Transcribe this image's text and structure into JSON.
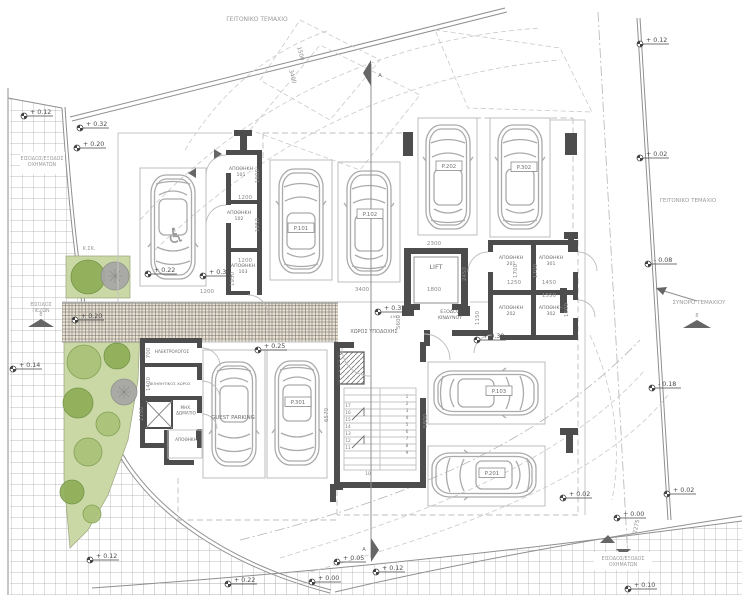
{
  "plan_title": "Ground floor parking site plan",
  "texts": [
    {
      "name": "neighbor-plot-top",
      "t": "ΓΕΙΤΟΝΙΚΟ ΤΕΜΑΧΙΟ",
      "x": 257,
      "y": 21,
      "s": 6,
      "cls": "lt"
    },
    {
      "name": "neighbor-plot-right",
      "t": "ΓΕΙΤΟΝΙΚΟ ΤΕΜΑΧΙΟ",
      "x": 688,
      "y": 202,
      "s": 5.5,
      "cls": "lt"
    },
    {
      "name": "plot-boundary-label",
      "t": "ΣΥΝΟΡΟ ΤΕΜΑΧΙΟΥ",
      "x": 699,
      "y": 304,
      "s": 5.5,
      "cls": "lt"
    },
    {
      "name": "vehicle-entry-top-label",
      "lines": [
        "ΕΙΣΟΔΟΣ/ΕΞΟΔΟΣ",
        "ΟΧΗΜΑΤΩΝ"
      ],
      "x": 42,
      "y": 160,
      "s": 4.8,
      "cls": "lt"
    },
    {
      "name": "vehicle-entry-bottom-label",
      "lines": [
        "ΕΙΣΟΔΟΣ/ΕΞΟΔΟΣ",
        "ΟΧΗΜΑΤΩΝ"
      ],
      "x": 623,
      "y": 560,
      "s": 4.8,
      "cls": "lt"
    },
    {
      "name": "pedestrian-entry-label",
      "lines": [
        "ΕΙΣΟΔΟΣ",
        "ΠΕΖΩΝ"
      ],
      "x": 41,
      "y": 306,
      "s": 4.8,
      "cls": "lt"
    },
    {
      "name": "ksk-label",
      "t": "Κ.ΣΚ.",
      "x": 89,
      "y": 250,
      "s": 5,
      "cls": "lt"
    },
    {
      "name": "lift-label",
      "t": "LIFT",
      "x": 436,
      "y": 269,
      "s": 6.5
    },
    {
      "name": "reception-label",
      "t": "ΧΩΡΟΣ ΥΠΟΔΟΧΗΣ",
      "x": 374,
      "y": 333,
      "s": 5
    },
    {
      "name": "emergency-exit-label",
      "lines": [
        "ΕΞΟΔΟΣ",
        "ΚΙΝΔΥΝΟΥ"
      ],
      "x": 450,
      "y": 313,
      "s": 4.7
    },
    {
      "name": "storage-101-label",
      "lines": [
        "ΑΠΟΘΗΚΗ",
        "101"
      ],
      "x": 241,
      "y": 170,
      "s": 4.7
    },
    {
      "name": "storage-102-label",
      "lines": [
        "ΑΠΟΘΗΚΗ",
        "102"
      ],
      "x": 239,
      "y": 214,
      "s": 4.7
    },
    {
      "name": "storage-103-label",
      "lines": [
        "ΑΠΟΘΗΚΗ",
        "103"
      ],
      "x": 243,
      "y": 267,
      "s": 4.7
    },
    {
      "name": "storage-201-label",
      "lines": [
        "ΑΠΟΘΗΚΗ",
        "201"
      ],
      "x": 511,
      "y": 259,
      "s": 4.7
    },
    {
      "name": "storage-301-label",
      "lines": [
        "ΑΠΟΘΗΚΗ",
        "301"
      ],
      "x": 551,
      "y": 259,
      "s": 4.7
    },
    {
      "name": "storage-202-label",
      "lines": [
        "ΑΠΟΘΗΚΗ",
        "202"
      ],
      "x": 511,
      "y": 309,
      "s": 4.7
    },
    {
      "name": "storage-302-label",
      "lines": [
        "ΑΠΟΘΗΚΗ",
        "302"
      ],
      "x": 551,
      "y": 309,
      "s": 4.7
    },
    {
      "name": "electrical-room-label",
      "t": "ΗΛΕΚΤΡΟΛΟΓΟΣ",
      "x": 172,
      "y": 353,
      "s": 4.2
    },
    {
      "name": "auxiliary-room-label",
      "t": "ΒΟΗΘΗΤΙΚΟΣ ΧΩΡΟΣ",
      "x": 170,
      "y": 385,
      "s": 3.9
    },
    {
      "name": "machine-room-label",
      "lines": [
        "ΜΗΧ.",
        "ΔΩΜΑΤΙΟ"
      ],
      "x": 186,
      "y": 409,
      "s": 4.2
    },
    {
      "name": "storage-small-label",
      "t": "ΑΠΟΘΗΚΗ",
      "x": 186,
      "y": 441,
      "s": 4.2
    },
    {
      "name": "section-a-top-label",
      "t": "A",
      "x": 380,
      "y": 77,
      "s": 5
    },
    {
      "name": "section-a-bottom-label",
      "t": "A",
      "x": 364,
      "y": 551,
      "s": 5
    },
    {
      "name": "road-mark-left",
      "t": "8",
      "x": 41,
      "y": 316,
      "s": 5,
      "cls": "lt"
    },
    {
      "name": "road-mark-right",
      "t": "8",
      "x": 697,
      "y": 317,
      "s": 5,
      "cls": "lt"
    },
    {
      "name": "dim-note",
      "t": "4951",
      "x": 395,
      "y": 318,
      "s": 3.8,
      "cls": "dim"
    },
    {
      "name": "wheelchair-icon",
      "t": "♿",
      "x": 176,
      "y": 243,
      "s": 21,
      "cls": "wc"
    }
  ],
  "parking": [
    {
      "t": "P.101",
      "x": 301,
      "y": 230,
      "box": true
    },
    {
      "t": "P.102",
      "x": 370,
      "y": 216,
      "box": true
    },
    {
      "t": "P.202",
      "x": 449,
      "y": 168,
      "box": true
    },
    {
      "t": "P.302",
      "x": 524,
      "y": 169,
      "box": true
    },
    {
      "t": "P.103",
      "x": 499,
      "y": 393,
      "box": true
    },
    {
      "t": "P.201",
      "x": 492,
      "y": 475,
      "box": true
    },
    {
      "t": "P.301",
      "x": 298,
      "y": 404,
      "box": true
    },
    {
      "t": "GUEST PARKING",
      "x": 233,
      "y": 419,
      "box": false
    }
  ],
  "levels": [
    {
      "t": "+ 0.12",
      "x": 24,
      "y": 116
    },
    {
      "t": "+ 0.32",
      "x": 80,
      "y": 128
    },
    {
      "t": "+ 0.20",
      "x": 77,
      "y": 148
    },
    {
      "t": "+ 0.14",
      "x": 13,
      "y": 369
    },
    {
      "t": "+ 0.20",
      "x": 75,
      "y": 320
    },
    {
      "t": "+ 0.22",
      "x": 148,
      "y": 274
    },
    {
      "t": "+ 0.30",
      "x": 203,
      "y": 276
    },
    {
      "t": "+ 0.25",
      "x": 258,
      "y": 350
    },
    {
      "t": "+ 0.35",
      "x": 378,
      "y": 312
    },
    {
      "t": "+ 0.30",
      "x": 477,
      "y": 340
    },
    {
      "t": "+ 0.12",
      "x": 640,
      "y": 44
    },
    {
      "t": "+ 0.02",
      "x": 640,
      "y": 158
    },
    {
      "t": "- 0.08",
      "x": 648,
      "y": 264
    },
    {
      "t": "- 0.18",
      "x": 652,
      "y": 388
    },
    {
      "t": "+ 0.02",
      "x": 563,
      "y": 498
    },
    {
      "t": "+ 0.02",
      "x": 667,
      "y": 494
    },
    {
      "t": "+ 0.00",
      "x": 617,
      "y": 518
    },
    {
      "t": "+ 0.12",
      "x": 90,
      "y": 560
    },
    {
      "t": "+ 0.22",
      "x": 228,
      "y": 584
    },
    {
      "t": "+ 0.00",
      "x": 312,
      "y": 582
    },
    {
      "t": "+ 0.05",
      "x": 337,
      "y": 562
    },
    {
      "t": "+ 0.12",
      "x": 376,
      "y": 572
    },
    {
      "t": "+ 0.10",
      "x": 628,
      "y": 589
    }
  ],
  "dims": [
    {
      "t": "1500",
      "x": 299,
      "y": 54,
      "r": 75
    },
    {
      "t": "3400",
      "x": 291,
      "y": 77,
      "r": 75
    },
    {
      "t": "1200",
      "x": 245,
      "y": 199
    },
    {
      "t": "1900",
      "x": 259,
      "y": 176,
      "r": -90
    },
    {
      "t": "1950",
      "x": 259,
      "y": 225,
      "r": -90
    },
    {
      "t": "1200",
      "x": 245,
      "y": 262
    },
    {
      "t": "1950",
      "x": 234,
      "y": 279,
      "r": -90
    },
    {
      "t": "1200",
      "x": 207,
      "y": 293
    },
    {
      "t": "3400",
      "x": 362,
      "y": 291
    },
    {
      "t": "1800",
      "x": 434,
      "y": 291
    },
    {
      "t": "2300",
      "x": 434,
      "y": 245
    },
    {
      "t": "2450",
      "x": 466,
      "y": 274,
      "r": -90
    },
    {
      "t": "5600",
      "x": 400,
      "y": 322,
      "r": -90
    },
    {
      "t": "1150",
      "x": 479,
      "y": 318,
      "r": -90
    },
    {
      "t": "1250",
      "x": 514,
      "y": 284
    },
    {
      "t": "1450",
      "x": 549,
      "y": 284
    },
    {
      "t": "1550",
      "x": 549,
      "y": 297
    },
    {
      "t": "1700",
      "x": 517,
      "y": 271,
      "r": -90
    },
    {
      "t": "1700",
      "x": 537,
      "y": 271,
      "r": -90
    },
    {
      "t": "1600",
      "x": 568,
      "y": 310,
      "r": -90
    },
    {
      "t": "700",
      "x": 150,
      "y": 353,
      "r": -90
    },
    {
      "t": "1400",
      "x": 150,
      "y": 384,
      "r": -90
    },
    {
      "t": "1150",
      "x": 143,
      "y": 414,
      "r": -90
    },
    {
      "t": "5800",
      "x": 427,
      "y": 421,
      "r": -90
    },
    {
      "t": "6570",
      "x": 328,
      "y": 415,
      "r": -90
    },
    {
      "t": "2275",
      "x": 638,
      "y": 527,
      "r": -78
    }
  ],
  "stair_numbers": [
    {
      "t": "1",
      "x": 407,
      "y": 398
    },
    {
      "t": "2",
      "x": 407,
      "y": 405
    },
    {
      "t": "3",
      "x": 407,
      "y": 412
    },
    {
      "t": "4",
      "x": 407,
      "y": 419
    },
    {
      "t": "5",
      "x": 407,
      "y": 426
    },
    {
      "t": "6",
      "x": 407,
      "y": 433
    },
    {
      "t": "7",
      "x": 407,
      "y": 440
    },
    {
      "t": "8",
      "x": 407,
      "y": 447
    },
    {
      "t": "9",
      "x": 407,
      "y": 454
    },
    {
      "t": "17",
      "x": 348,
      "y": 407
    },
    {
      "t": "16",
      "x": 348,
      "y": 414
    },
    {
      "t": "15",
      "x": 348,
      "y": 421
    },
    {
      "t": "14",
      "x": 348,
      "y": 428
    },
    {
      "t": "13",
      "x": 348,
      "y": 435
    },
    {
      "t": "12",
      "x": 348,
      "y": 442
    },
    {
      "t": "11",
      "x": 348,
      "y": 449
    },
    {
      "t": "10",
      "x": 368,
      "y": 475
    }
  ],
  "colors": {
    "wall": "#4d4d4d",
    "line_light": "#c4c4c4",
    "line_mid": "#8f8f8f",
    "paving": "#eae1d1",
    "green_area": "#c9d8a4",
    "tree_green": "#8fae58",
    "tree_gray": "#a6a6a6"
  }
}
